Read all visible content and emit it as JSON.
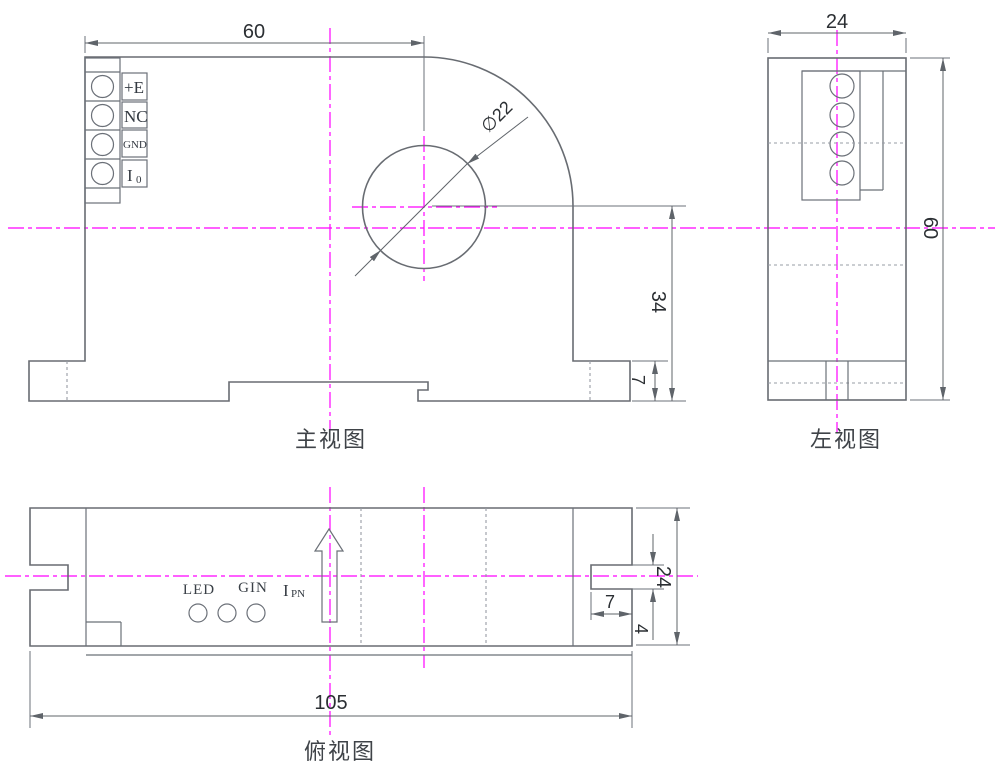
{
  "colors": {
    "outline": "#686c72",
    "hidden_line": "#979ca4",
    "centerline": "#ff00ff",
    "dimension_text": "#2b2f33",
    "background": "#ffffff"
  },
  "front_view": {
    "label": "主视图",
    "dim_width": "60",
    "dim_hole_dia": "∅22",
    "dim_center_to_bottom": "34",
    "dim_foot_height": "7",
    "terminals": [
      "+E",
      "NC",
      "GND"
    ],
    "terminal4_main": "I",
    "terminal4_sub": "0"
  },
  "left_view": {
    "label": "左视图",
    "dim_width": "24",
    "dim_height": "60"
  },
  "top_view": {
    "label": "俯视图",
    "dim_length": "105",
    "dim_width": "24",
    "dim_slot_depth": "7",
    "dim_slot_height": "4",
    "led_label": "LED",
    "gin_label": "GIN",
    "ipn_main": "I",
    "ipn_sub": "PN"
  }
}
